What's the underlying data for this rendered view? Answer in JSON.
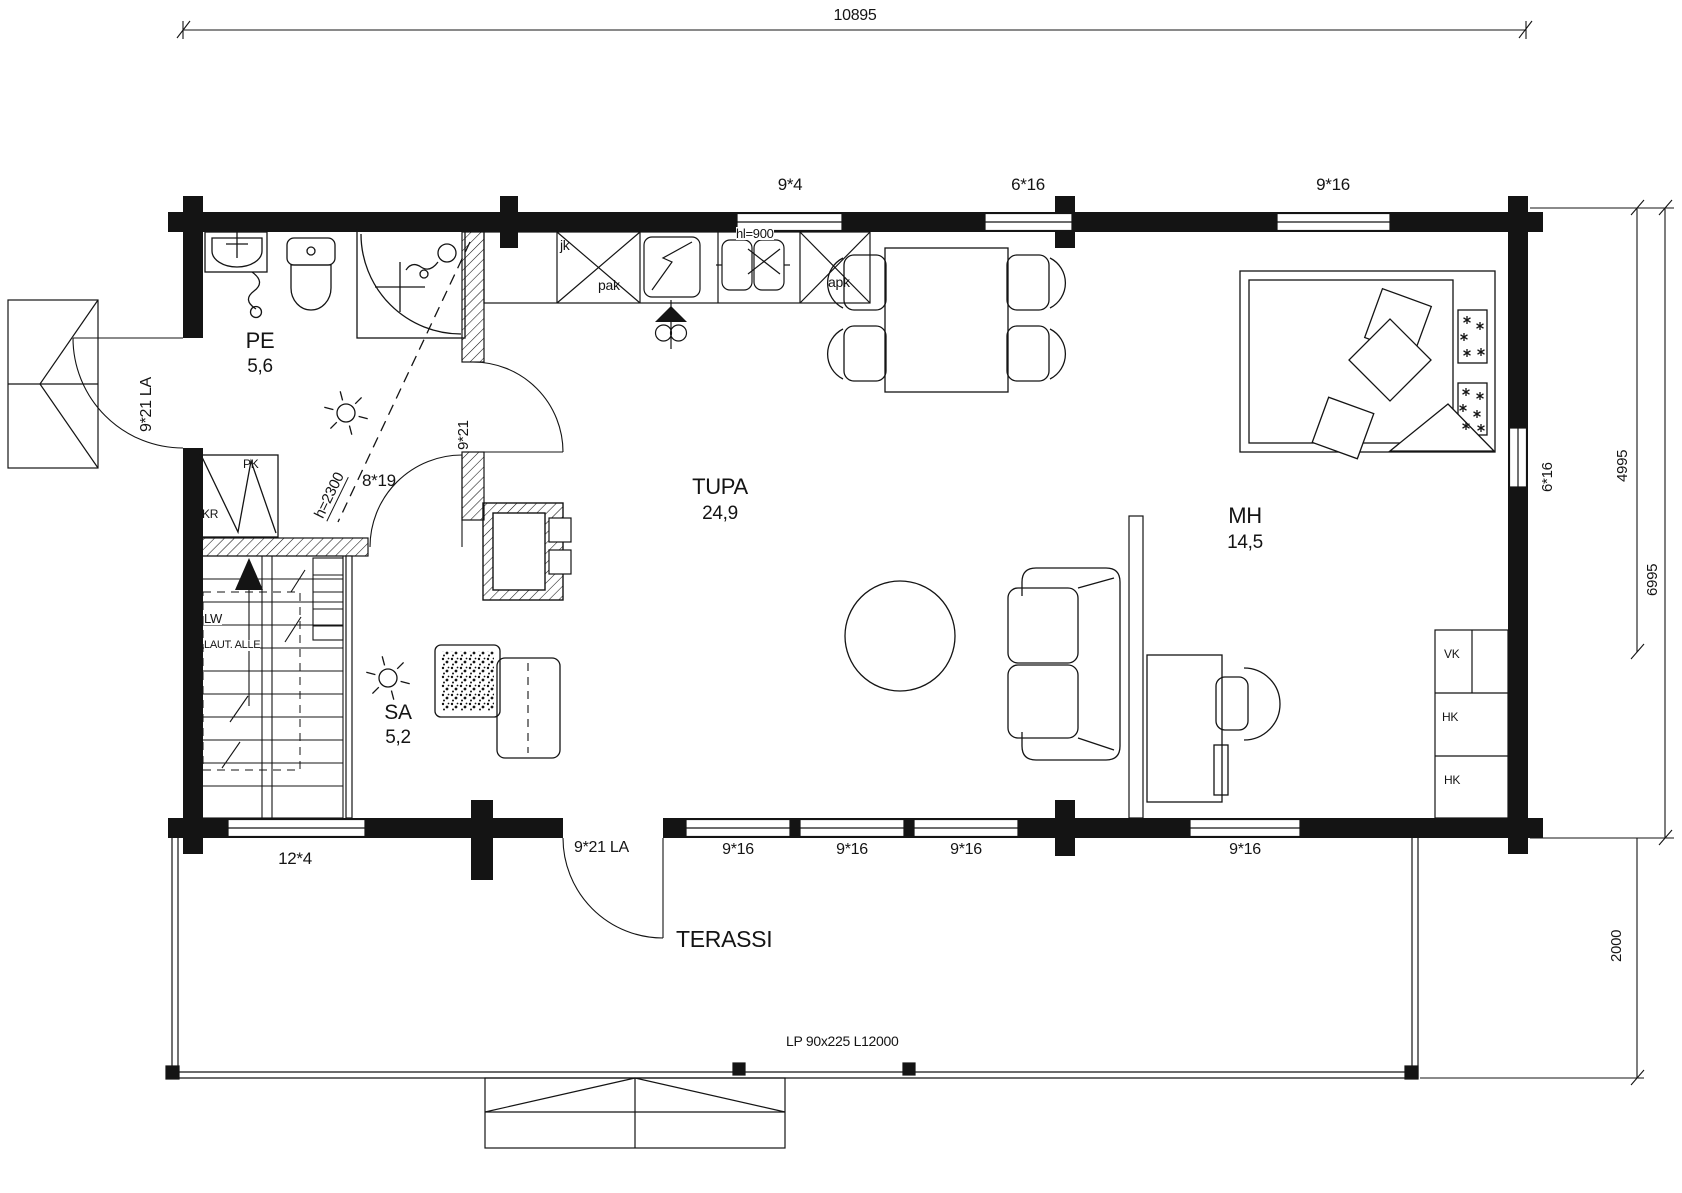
{
  "dimensions": {
    "top": "10895",
    "right_upper": "4995",
    "right_total": "6995",
    "terrace_depth": "2000"
  },
  "rooms": {
    "pe": {
      "name": "PE",
      "area": "5,6"
    },
    "sa": {
      "name": "SA",
      "area": "5,2"
    },
    "tupa": {
      "name": "TUPA",
      "area": "24,9"
    },
    "mh": {
      "name": "MH",
      "area": "14,5"
    },
    "terassi": {
      "name": "TERASSI"
    }
  },
  "windows": {
    "top": [
      "9*4",
      "6*16",
      "9*16"
    ],
    "bottom": [
      "12*4",
      "9*16",
      "9*16",
      "9*16",
      "9*16"
    ],
    "right": "6*16"
  },
  "doors": {
    "left_exterior": "9*21 LA",
    "bottom_exterior": "9*21 LA",
    "interior_tupa": "9*21",
    "interior_sauna": "8*19"
  },
  "kitchen": {
    "jk": "jk",
    "pak": "pak",
    "apk": "apk",
    "counter_height": "hl=900"
  },
  "utility": {
    "pk": "PK",
    "kr": "KR"
  },
  "stairs": {
    "lw": "LW",
    "note": "LAUT. ALLE"
  },
  "closets": {
    "vk": "VK",
    "hk1": "HK",
    "hk2": "HK"
  },
  "notes": {
    "ceiling_height": "h=2300",
    "beam": "LP 90x225 L12000"
  }
}
